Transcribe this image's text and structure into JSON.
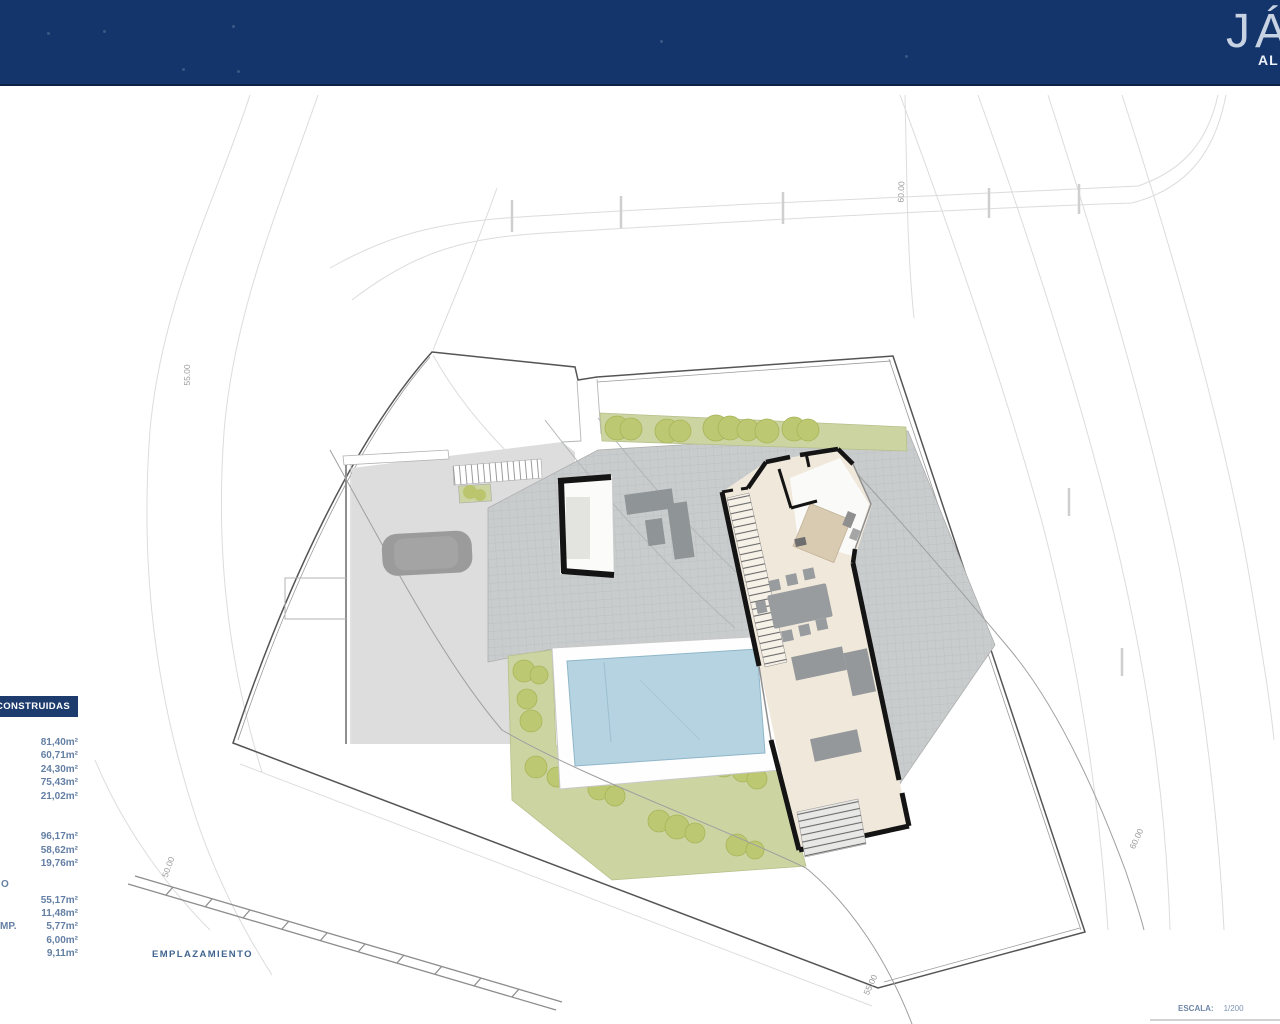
{
  "header": {
    "bg": "#14356b",
    "brand_main_visible": "JÁ",
    "brand_sub_visible": "AL"
  },
  "areas_table": {
    "title": "CONSTRUIDAS",
    "group1": [
      "81,40m²",
      "60,71m²",
      "24,30m²",
      "75,43m²",
      "21,02m²"
    ],
    "group2": [
      "96,17m²",
      "58,62m²",
      "19,76m²"
    ],
    "row_label_fragment_1": "O",
    "group3": [
      "55,17m²",
      "11,48m²",
      "5,77m²",
      "6,00m²",
      "9,11m²"
    ],
    "row_label_fragment_2": "MP."
  },
  "plan": {
    "caption": "EMPLAZAMIENTO",
    "scale_label": "ESCALA:",
    "scale_value": "1/200",
    "contour_labels": [
      "55.00",
      "50.00",
      "60.00",
      "60.00",
      "55.00"
    ]
  },
  "colors": {
    "header_navy": "#14356b",
    "table_navy": "#1d3c6d",
    "value_blue": "#647fa4",
    "pool_blue": "#b5d3e1",
    "garden_green": "#ccd5a2",
    "tree_olive": "#bdc873",
    "terrace_gray": "#c9cccd",
    "interior_beige": "#f0e8db",
    "wall_black": "#141414"
  }
}
